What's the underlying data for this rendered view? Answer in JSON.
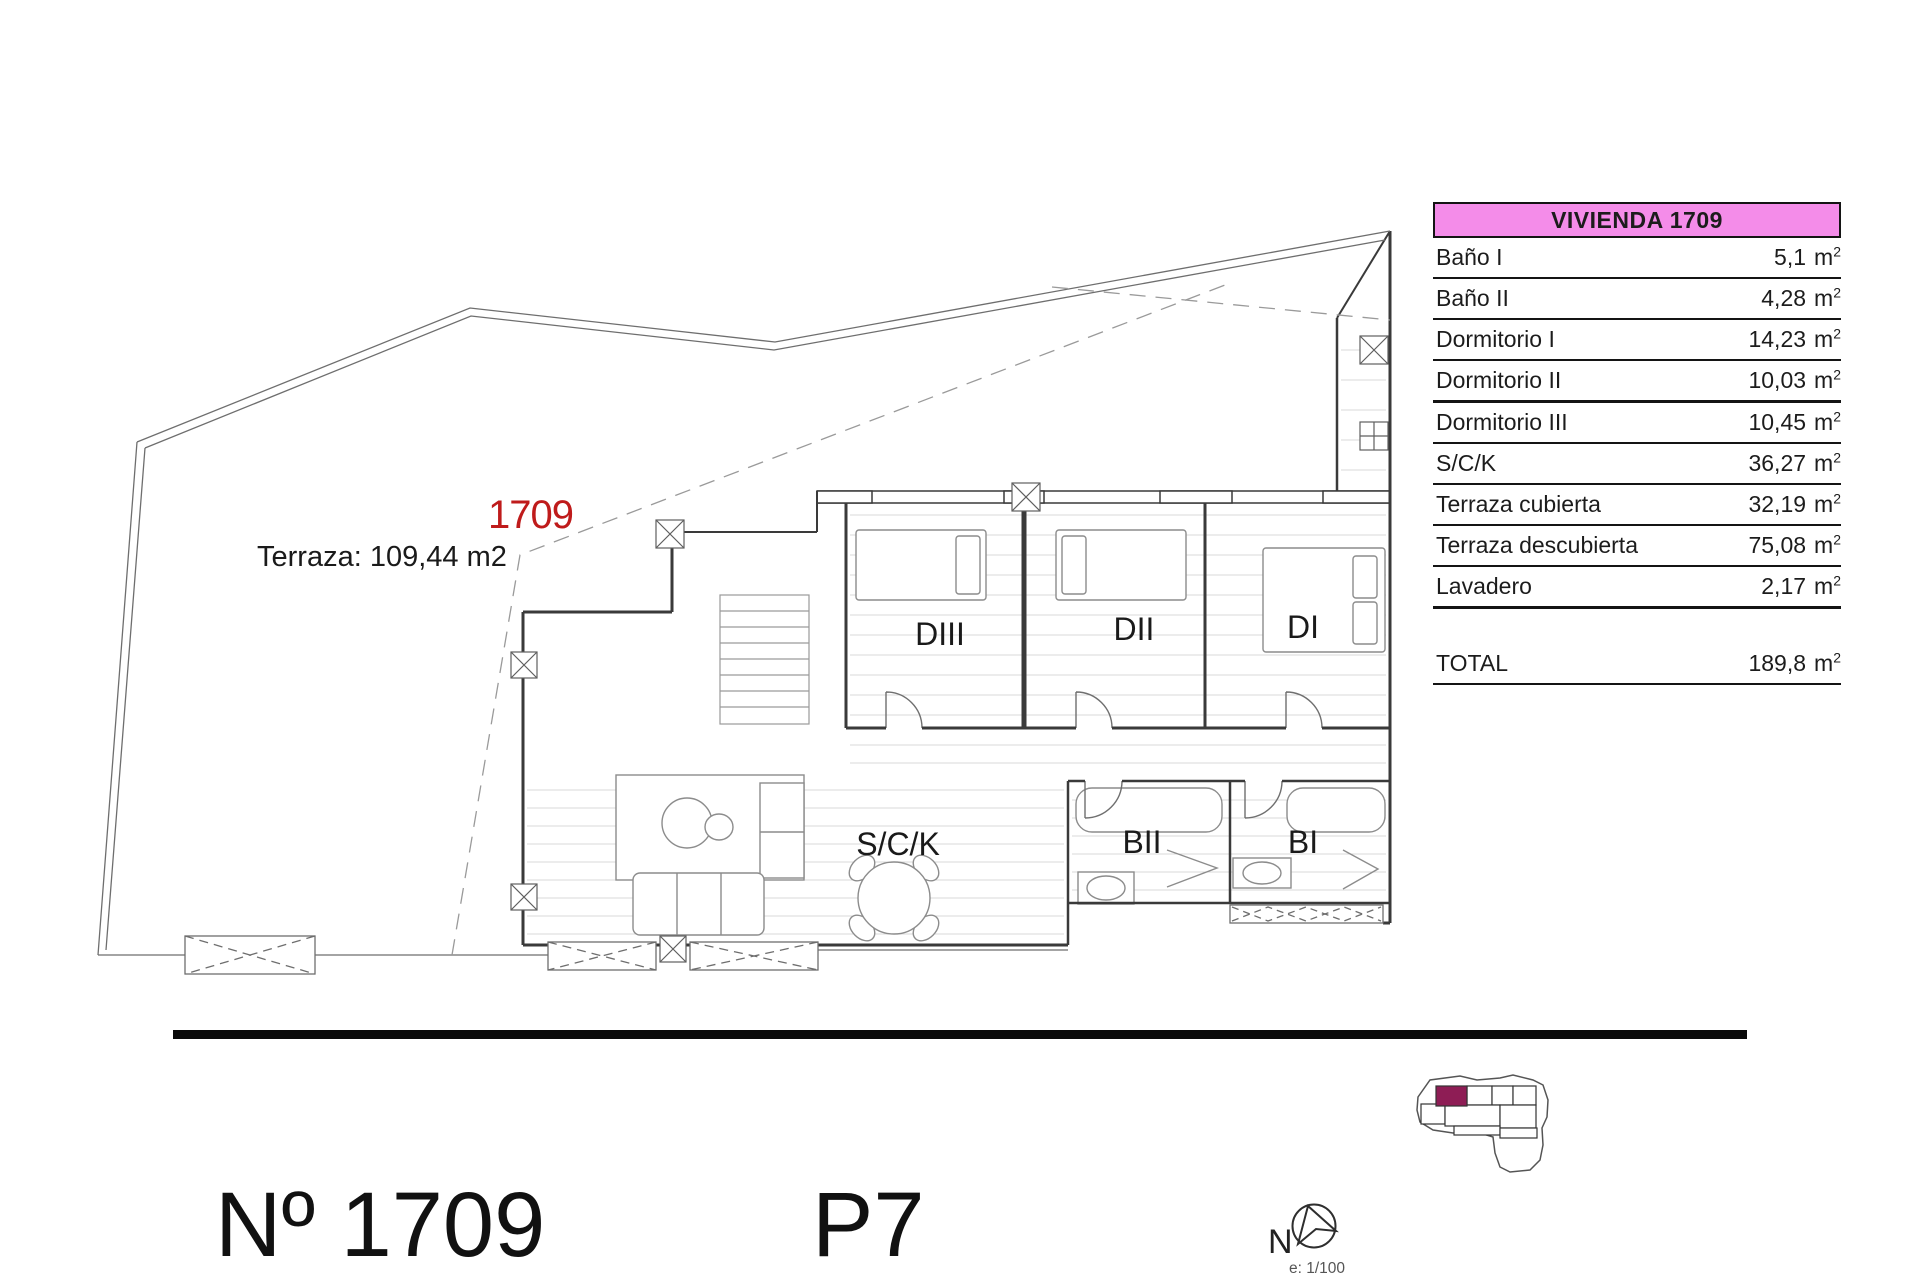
{
  "colors": {
    "accent_pink": "#F48CE9",
    "red_label": "#BF1B1B",
    "keyplan_highlight": "#8E1D55"
  },
  "plan": {
    "unit_label": "1709",
    "terrace_note": "Terraza: 109,44 m2",
    "rooms": {
      "dormitorio3": "DIII",
      "dormitorio2": "DII",
      "dormitorio1": "DI",
      "salon_cocina": "S/C/K",
      "bano2": "BII",
      "bano1": "BI"
    }
  },
  "table": {
    "title": "VIVIENDA 1709",
    "unit": "m",
    "unit_sup": "2",
    "rows": [
      {
        "label": "Baño I",
        "value": "5,1"
      },
      {
        "label": "Baño II",
        "value": "4,28"
      },
      {
        "label": "Dormitorio I",
        "value": "14,23"
      },
      {
        "label": "Dormitorio II",
        "value": "10,03"
      },
      {
        "label": "Dormitorio III",
        "value": "10,45"
      },
      {
        "label": "S/C/K",
        "value": "36,27"
      },
      {
        "label": "Terraza cubierta",
        "value": "32,19"
      },
      {
        "label": "Terraza descubierta",
        "value": "75,08"
      },
      {
        "label": "Lavadero",
        "value": "2,17"
      }
    ],
    "total": {
      "label": "TOTAL",
      "value": "189,8"
    }
  },
  "footer": {
    "unit_number": "Nº 1709",
    "floor": "P7",
    "north": "N",
    "scale": "e: 1/100"
  }
}
